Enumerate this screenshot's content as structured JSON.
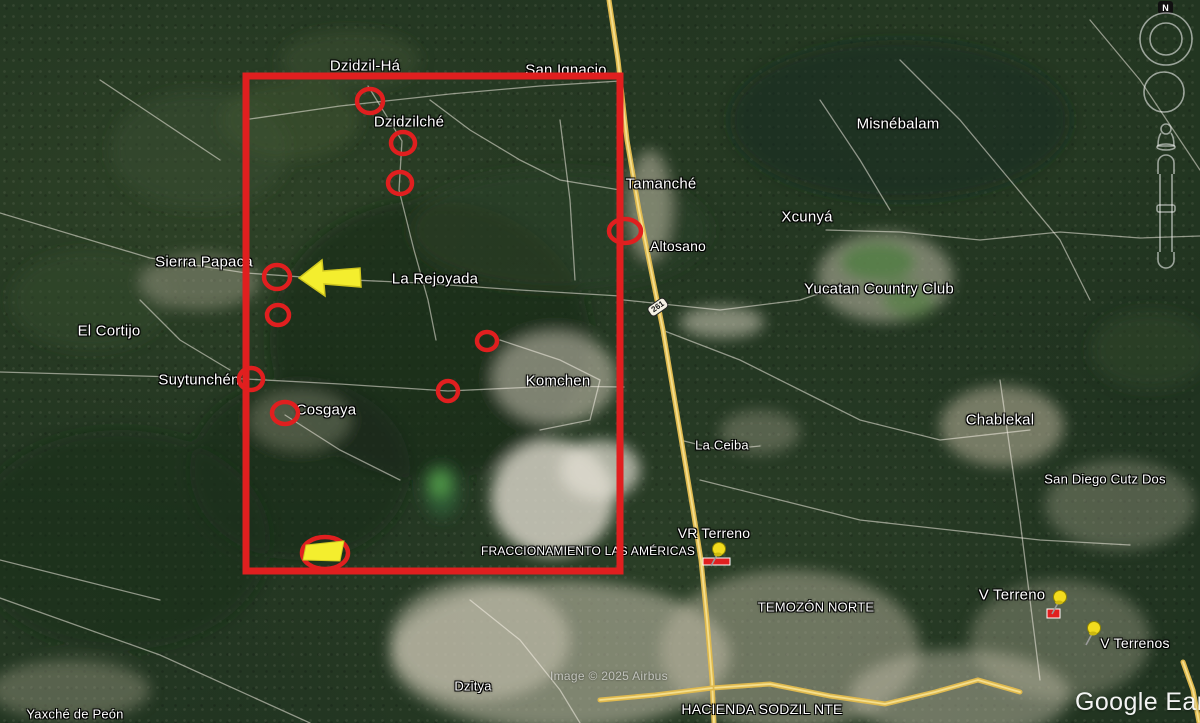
{
  "app": {
    "name": "Google Earth"
  },
  "watermarks": {
    "logo": "Google Earth",
    "attribution": "Image © 2025 Airbus"
  },
  "navigation": {
    "north_label": "N"
  },
  "route_shield": {
    "text": "261",
    "x": 658,
    "y": 307
  },
  "colors": {
    "annotation_red": "#e01f1f",
    "arrow_yellow": "#f4ee2e",
    "arrow_edge": "#cfc61f",
    "highway": "#dfb94e",
    "highway_light": "#f4df8e",
    "pin_yellow": "#f2dc1e",
    "pin_edge": "#8f8400",
    "road_white": "rgba(255,250,240,0.5)",
    "label_text": "#ffffff"
  },
  "labels": [
    {
      "id": "dzidzil-ha",
      "text": "Dzidzil-Há",
      "x": 365,
      "y": 66,
      "fs": 15
    },
    {
      "id": "san-ignacio",
      "text": "San Ignacio",
      "x": 566,
      "y": 70,
      "fs": 15
    },
    {
      "id": "dzidzilche",
      "text": "Dzidzilché",
      "x": 409,
      "y": 122,
      "fs": 15
    },
    {
      "id": "misnebalam",
      "text": "Misnébalam",
      "x": 898,
      "y": 124,
      "fs": 15
    },
    {
      "id": "tamanche",
      "text": "Tamanché",
      "x": 661,
      "y": 184,
      "fs": 15
    },
    {
      "id": "xcunya",
      "text": "Xcunyá",
      "x": 807,
      "y": 217,
      "fs": 15
    },
    {
      "id": "altosano",
      "text": "Altosano",
      "x": 678,
      "y": 246,
      "fs": 14
    },
    {
      "id": "yucatan-country-club",
      "text": "Yucatan Country Club",
      "x": 879,
      "y": 289,
      "fs": 15
    },
    {
      "id": "sierra-papaca",
      "text": "Sierra Papaca",
      "x": 204,
      "y": 262,
      "fs": 15
    },
    {
      "id": "la-rejoyada",
      "text": "La Rejoyada",
      "x": 435,
      "y": 279,
      "fs": 15
    },
    {
      "id": "el-cortijo",
      "text": "El Cortijo",
      "x": 109,
      "y": 331,
      "fs": 15
    },
    {
      "id": "suytunchen",
      "text": "Suytunchén",
      "x": 199,
      "y": 380,
      "fs": 15
    },
    {
      "id": "komchen",
      "text": "Komchen",
      "x": 558,
      "y": 381,
      "fs": 15
    },
    {
      "id": "cosgaya",
      "text": "Cosgaya",
      "x": 326,
      "y": 410,
      "fs": 15
    },
    {
      "id": "la-ceiba",
      "text": "La Ceiba",
      "x": 722,
      "y": 445,
      "fs": 13
    },
    {
      "id": "chablekal",
      "text": "Chablekal",
      "x": 1000,
      "y": 420,
      "fs": 15
    },
    {
      "id": "san-diego-cutz-dos",
      "text": "San Diego Cutz Dos",
      "x": 1105,
      "y": 479,
      "fs": 13
    },
    {
      "id": "vr-terreno",
      "text": "VR Terreno",
      "x": 714,
      "y": 533,
      "fs": 14
    },
    {
      "id": "v-terreno",
      "text": "V Terreno",
      "x": 1012,
      "y": 595,
      "fs": 15
    },
    {
      "id": "v-terrenos",
      "text": "V Terrenos",
      "x": 1135,
      "y": 643,
      "fs": 14
    },
    {
      "id": "fraccionamiento-las-americas",
      "text": "FRACCIONAMIENTO LAS AMÉRICAS",
      "x": 588,
      "y": 551,
      "fs": 12
    },
    {
      "id": "temozon-norte",
      "text": "TEMOZÓN NORTE",
      "x": 816,
      "y": 607,
      "fs": 13
    },
    {
      "id": "hacienda-sodzil-nte",
      "text": "HACIENDA SODZIL NTE",
      "x": 762,
      "y": 709,
      "fs": 14
    },
    {
      "id": "dzitya",
      "text": "Dzitya",
      "x": 473,
      "y": 686,
      "fs": 13
    },
    {
      "id": "yaxche-de-peon",
      "text": "Yaxché de Peón",
      "x": 75,
      "y": 714,
      "fs": 13
    }
  ],
  "annotations": {
    "focus_rect": {
      "x": 246,
      "y": 76,
      "w": 374,
      "h": 495,
      "stroke_width": 7
    },
    "circles": [
      [
        370,
        101,
        13,
        12
      ],
      [
        403,
        143,
        12,
        11
      ],
      [
        400,
        183,
        12,
        11
      ],
      [
        625,
        231,
        16,
        12
      ],
      [
        277,
        277,
        13,
        12
      ],
      [
        278,
        315,
        11,
        10
      ],
      [
        487,
        341,
        10,
        9
      ],
      [
        251,
        379,
        12,
        11
      ],
      [
        285,
        413,
        13,
        11
      ],
      [
        448,
        391,
        10,
        10
      ]
    ],
    "arrow_points": "299,278 322,260 323,271 360,268 361,287 324,284 325,296",
    "site_marker": {
      "ellipse": [
        325,
        553,
        23,
        16
      ],
      "polygon": "306,545 344,541 340,561 303,560"
    },
    "pins": [
      {
        "id": "vr-terreno-pin",
        "x": 719,
        "y": 549
      },
      {
        "id": "v-terreno-pin",
        "x": 1060,
        "y": 597
      },
      {
        "id": "v-terrenos-pin",
        "x": 1094,
        "y": 628
      }
    ],
    "red_markers": [
      [
        703,
        558,
        27,
        7
      ],
      [
        1047,
        609,
        13,
        9
      ]
    ]
  },
  "map": {
    "roads_white": [
      "0,213 150,258 246,273 330,279 420,283 520,290 620,296",
      "250,119 340,106 450,94 540,86 620,81",
      "368,86 402,141 399,190 414,250 428,300 436,340",
      "0,372 246,379 340,384 448,391 556,386 624,387",
      "500,340 560,360 600,380 590,420 540,430",
      "430,100 470,130 520,160 560,180 620,190",
      "624,300 720,310 800,300 830,290",
      "662,330 740,360 800,390 860,420 940,440 1030,430",
      "900,60 960,120 1010,180 1060,240 1090,300",
      "1090,20 1140,80 1180,140 1200,170",
      "826,230 900,232 980,240 1060,232 1140,238 1200,236",
      "700,480 780,500 860,520 950,530 1040,540 1130,545",
      "1000,380 1010,450 1020,520 1030,600 1040,680",
      "680,440 720,450 760,446",
      "285,415 340,450 400,480",
      "140,300 180,340 230,370",
      "0,560 80,580 160,600",
      "470,600 520,640 560,690 580,723",
      "820,100 860,160 890,210",
      "100,80 160,120 220,160",
      "560,120 570,200 575,280",
      "0,598 160,655 310,723"
    ],
    "roads_yellow": [
      "609,0 618,60 627,140 639,210 651,270 663,330 673,390 683,450 693,510 701,560 707,620 712,680 714,723",
      "712,688 770,684 830,696 885,704 935,692 978,680 1020,692",
      "712,688 655,695 600,700",
      "1183,662 1193,690 1199,722"
    ],
    "patches": [
      [
        430,
        340,
        160,
        140,
        "#16281a",
        0.55
      ],
      [
        300,
        470,
        110,
        90,
        "#17291a",
        0.5
      ],
      [
        900,
        120,
        170,
        80,
        "#1a2d1d",
        0.5
      ],
      [
        120,
        540,
        150,
        110,
        "#1b2f1d",
        0.45
      ],
      [
        560,
        230,
        150,
        60,
        "#2e4427",
        0.5
      ],
      [
        200,
        150,
        90,
        60,
        "#3c5030",
        0.45
      ],
      [
        90,
        300,
        80,
        50,
        "#3a4e33",
        0.4
      ],
      [
        290,
        120,
        70,
        40,
        "#42552f",
        0.5
      ],
      [
        350,
        60,
        70,
        30,
        "#3e5231",
        0.45
      ],
      [
        1150,
        350,
        60,
        40,
        "#334a2e",
        0.45
      ],
      [
        555,
        378,
        62,
        46,
        "#cfc9b6",
        0.55
      ],
      [
        553,
        498,
        62,
        58,
        "#dedacd",
        0.8
      ],
      [
        600,
        470,
        40,
        30,
        "#e4e0d4",
        0.7
      ],
      [
        560,
        655,
        170,
        75,
        "#c9c2ae",
        0.55
      ],
      [
        790,
        650,
        130,
        80,
        "#c3bca8",
        0.45
      ],
      [
        960,
        695,
        110,
        45,
        "#ccc5b2",
        0.45
      ],
      [
        722,
        322,
        42,
        16,
        "#d6d0be",
        0.55
      ],
      [
        885,
        277,
        68,
        45,
        "#cdc7b4",
        0.5
      ],
      [
        878,
        262,
        40,
        22,
        "#4e7d40",
        0.75
      ],
      [
        908,
        300,
        28,
        18,
        "#4f7f3e",
        0.6
      ],
      [
        1002,
        426,
        62,
        40,
        "#c9bfa7",
        0.5
      ],
      [
        1120,
        505,
        75,
        45,
        "#b3b098",
        0.35
      ],
      [
        650,
        205,
        22,
        55,
        "#cfc8b4",
        0.5
      ],
      [
        760,
        432,
        40,
        22,
        "#b5b09a",
        0.35
      ],
      [
        200,
        282,
        60,
        28,
        "#b5b09a",
        0.4
      ],
      [
        300,
        420,
        50,
        30,
        "#a8a58d",
        0.35
      ],
      [
        442,
        492,
        18,
        26,
        "#2c5a33",
        0.9
      ],
      [
        440,
        484,
        10,
        13,
        "#55a04a",
        0.85
      ],
      [
        1060,
        640,
        90,
        60,
        "#b9b6a0",
        0.35
      ],
      [
        480,
        640,
        90,
        60,
        "#d2ccb9",
        0.5
      ],
      [
        70,
        690,
        80,
        30,
        "#b9b49e",
        0.35
      ]
    ]
  }
}
